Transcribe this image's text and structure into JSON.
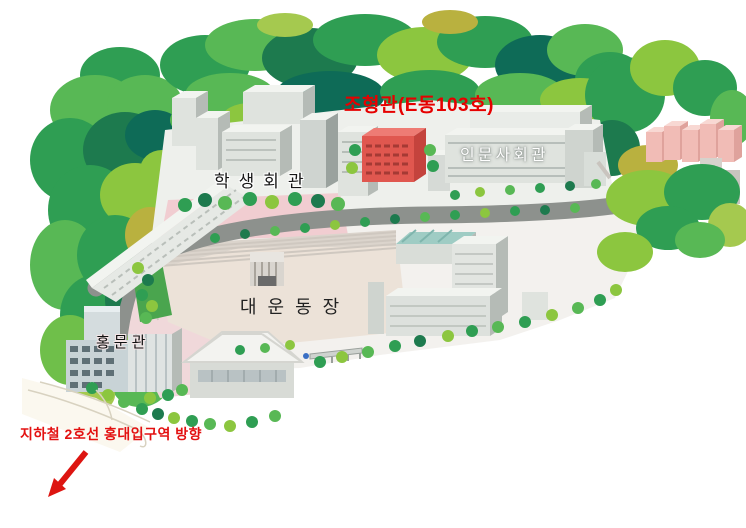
{
  "map": {
    "type": "campus-illustrated-map",
    "labels": {
      "johyeong": "조형관(E동103호)",
      "inmun": "인문사회관",
      "haksaeng": "학생회관",
      "daeun": "대운동장",
      "hongmun": "홍문관",
      "subway": "지하철 2호선 홍대입구역 방향"
    },
    "colors": {
      "highlight_text_red": "#e60000",
      "highlight_building_red": "#e0574f",
      "subway_text_red": "#e31111",
      "arrow_red": "#dd1511",
      "tree_green_mid": "#35a558",
      "tree_green_dark": "#1d7a4e",
      "tree_green_teal": "#0e6b57",
      "tree_green_light": "#8cc63f",
      "tree_olive": "#b9b13f",
      "building_grey": "#dfe3de",
      "building_shadow": "#b5bbb6",
      "apartment_pink": "#f1bcb6",
      "road_grey": "#8d918d",
      "field_beige": "#ece2d8",
      "plaza_pink": "#f1cdd1",
      "gym_roof_white": "#f3f3f0",
      "teal_roof": "#9fccc4"
    }
  }
}
